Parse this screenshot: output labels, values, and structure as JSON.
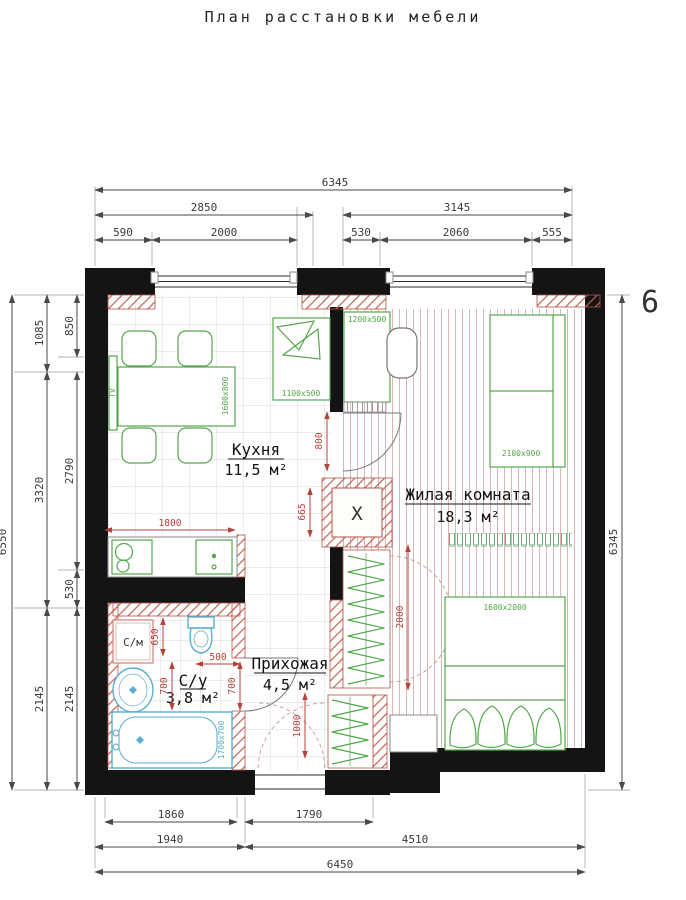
{
  "header": {
    "title": "План расстановки мебели",
    "apartment_number": "6"
  },
  "rooms": {
    "kitchen": {
      "name": "Кухня",
      "area": "11,5 м²"
    },
    "living": {
      "name": "Жилая комната",
      "area": "18,3 м²"
    },
    "bathroom": {
      "name": "С/у",
      "area": "3,8 м²"
    },
    "hallway": {
      "name": "Прихожая",
      "area": "4,5 м²"
    }
  },
  "furniture": {
    "table": "1600x800",
    "bench": "1100x500",
    "desk": "1200x500",
    "sofa": "2100x900",
    "bed": "1600x2000",
    "bathtub": "1700x700",
    "tv": "TV",
    "washer": "С/м",
    "shaft": "X"
  },
  "dimensions": {
    "top": {
      "total": "6345",
      "left_half": "2850",
      "right_half": "3145",
      "segments": [
        "590",
        "2000",
        "530",
        "2060",
        "555"
      ]
    },
    "left": {
      "outer_total": "6550",
      "col_mid": [
        "1085",
        "3320",
        "2145"
      ],
      "col_inner": [
        "850",
        "2790",
        "530",
        "2145"
      ]
    },
    "right": {
      "total": "6345"
    },
    "bottom": {
      "row1": [
        "1860",
        "1790"
      ],
      "row2": [
        "1940",
        "4510"
      ],
      "total": "6450"
    },
    "interior": {
      "counter": "1800",
      "shaft_h": "665",
      "kitchen_door": "800",
      "closet": "2000",
      "entry_door": "1000",
      "bath_650": "650",
      "bath_700_left": "700",
      "bath_500": "500",
      "bath_700_right": "700"
    }
  },
  "colors": {
    "walls": "#141414",
    "wall_lining": "#c4604f",
    "furniture": "#54a64b",
    "plumbing": "#58aed0",
    "interior_dims": "#b5423a",
    "outer_dims": "#3a3a3a",
    "living_floor_stripes": "#bb7878"
  }
}
